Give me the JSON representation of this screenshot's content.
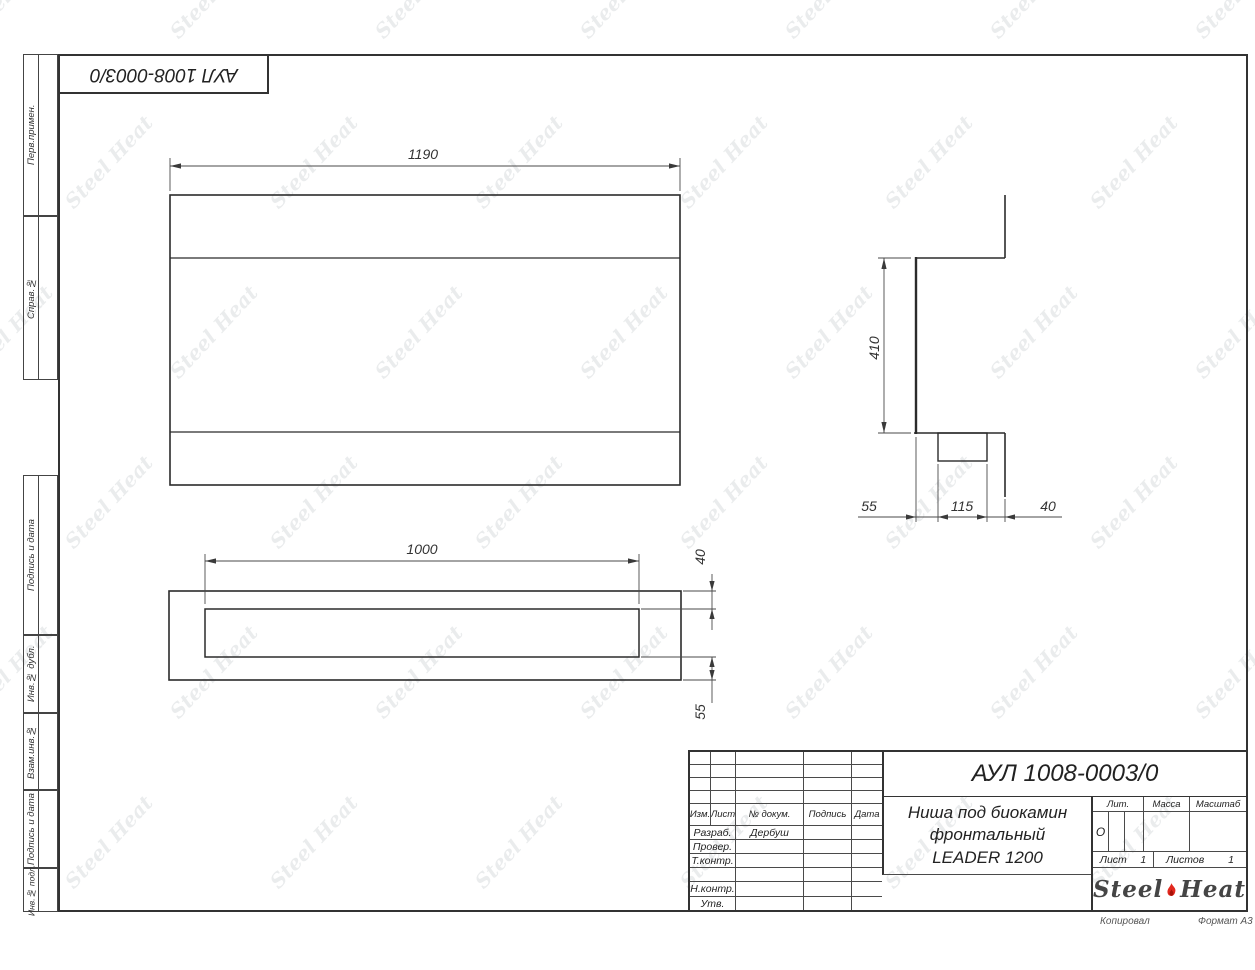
{
  "sheet": {
    "top_stamp": "АУЛ 1008-0003/0",
    "copied_label": "Копировал",
    "format_label": "Формат А3"
  },
  "margin_labels": {
    "perv_primen": "Перв.примен.",
    "sprav_no": "Справ.№",
    "podpis_i_data_1": "Подпись и дата",
    "inv_no_dubl": "Инв.№ дубл.",
    "vzam_inv_no": "Взам.инв.№",
    "podpis_i_data_2": "Подпись и дата",
    "inv_no_podl": "Инв.№ подл."
  },
  "title_block": {
    "designation": "АУЛ 1008-0003/0",
    "name_line1": "Ниша под биокамин",
    "name_line2": "фронтальный",
    "name_line3": "LEADER 1200",
    "header": {
      "izm": "Изм.",
      "list": "Лист",
      "dokum": "№ докум.",
      "podpis": "Подпись",
      "data": "Дата"
    },
    "rows": [
      {
        "label": "Разраб.",
        "value": "Дербуш"
      },
      {
        "label": "Провер.",
        "value": ""
      },
      {
        "label": "Т.контр.",
        "value": ""
      },
      {
        "label": "",
        "value": ""
      },
      {
        "label": "Н.контр.",
        "value": ""
      },
      {
        "label": "Утв.",
        "value": ""
      }
    ],
    "lit_label": "Лит.",
    "lit_value": "О",
    "massa_label": "Масса",
    "masshtab_label": "Масштаб",
    "list_label": "Лист",
    "list_value": "1",
    "listov_label": "Листов",
    "listov_value": "1",
    "logo_steel": "Steel",
    "logo_heat": "Heat",
    "flame_color": "#e2281e"
  },
  "watermark": {
    "text": "Steel Heat"
  },
  "drawing": {
    "front_view": {
      "width_label": "1190"
    },
    "side_view": {
      "height_label": "410",
      "depth_back": "55",
      "depth_mid": "115",
      "depth_front": "40"
    },
    "plan_view": {
      "width_label": "1000",
      "lip_label": "40",
      "back_label": "55"
    }
  }
}
